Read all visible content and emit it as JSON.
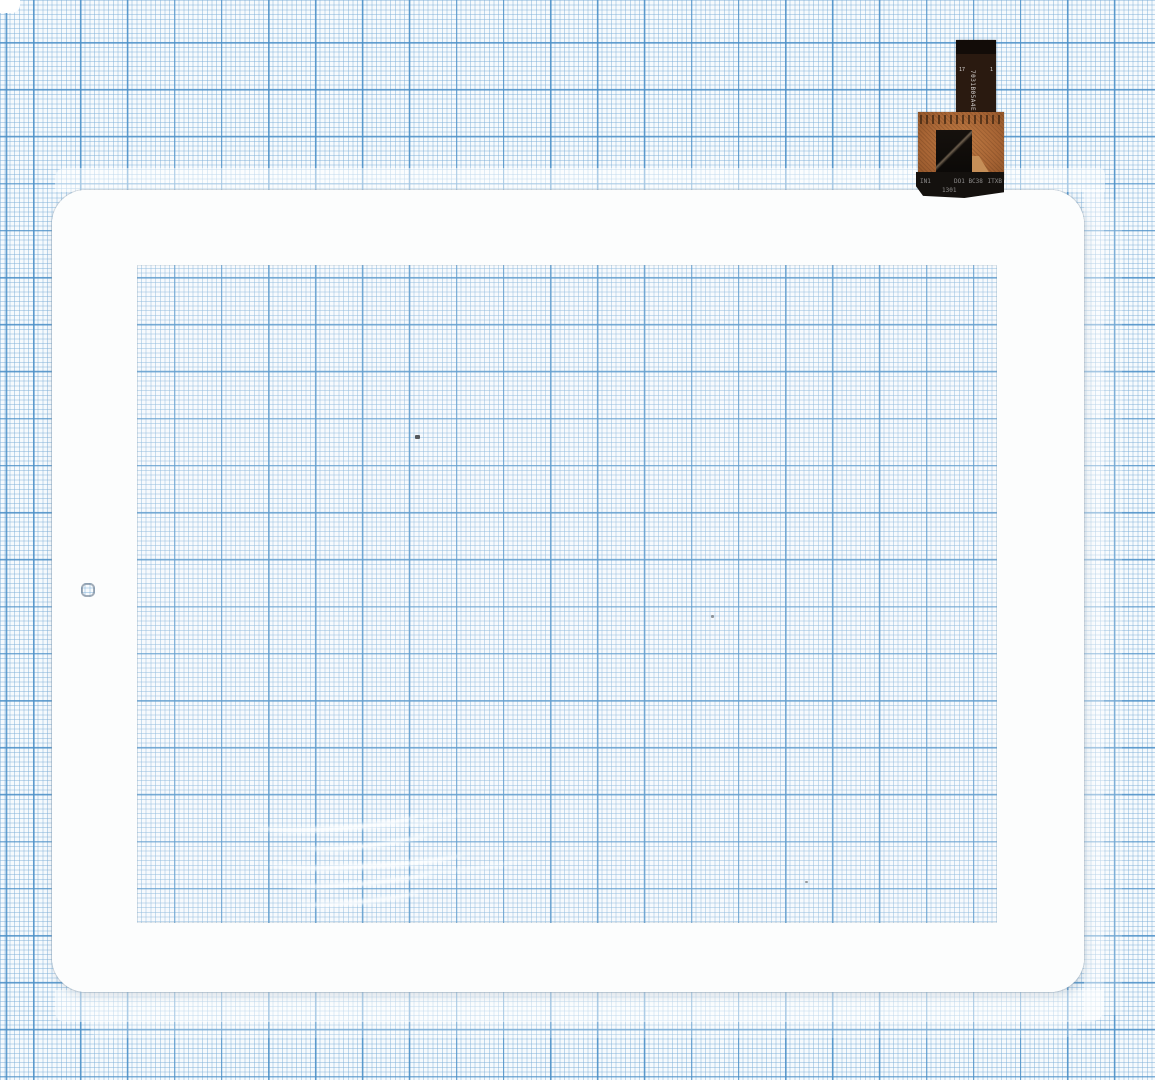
{
  "meta": {
    "alt": "White tablet touchscreen digitizer glass with flex ribbon cable and controller chip, photographed on blue millimeter graph paper"
  },
  "theme": {
    "paper-bg": "#f6fafd",
    "grid-minor": "#7fb0d87d",
    "grid-major": "#4a8fc7d9",
    "frame-color": "#fcfdfd",
    "flex-copper": "#a86535",
    "chip-black": "#0b0907",
    "ribbon-dark": "#2a1a10"
  },
  "flex": {
    "ribbon_label_top": "17",
    "ribbon_label_side": "1",
    "ribbon_vertical_text": "7031B05A4E12",
    "strip_text_left": "IN1",
    "strip_text_mid": "DO1 BC38",
    "strip_text_right": "ITXB",
    "strip_text_bottom": "1301"
  }
}
